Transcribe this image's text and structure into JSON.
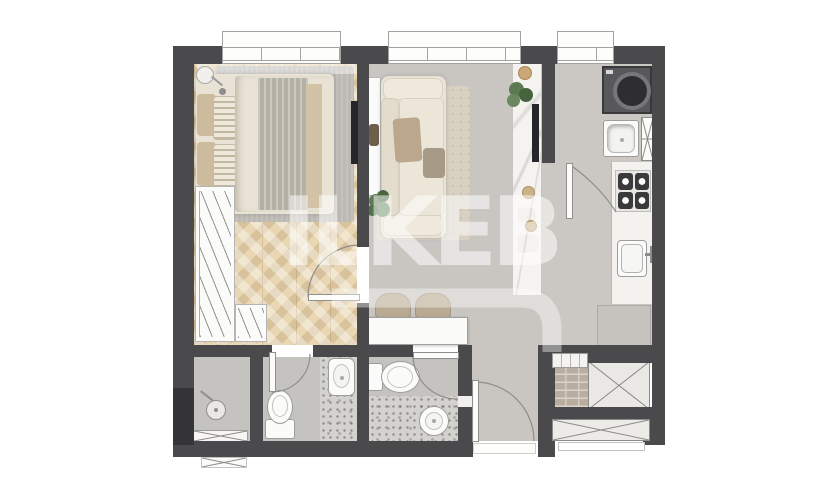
{
  "watermark": {
    "text": "ILKEB"
  },
  "colors": {
    "wall": "#4a4a4c",
    "wall_dark": "#353537",
    "wood": "#e9d6b2",
    "living_floor": "#c9c6c2",
    "kitchen_floor": "#cbc8c3",
    "bath_floor": "#c5c3c0",
    "terrazzo": "#d4d2ce",
    "marble": "#f5f3f0",
    "cream": "#e9e3d5",
    "cream_light": "#efe9dc",
    "tan": "#bba88c",
    "rug_bedroom": "#bcb9b3",
    "rug_living": "#d8d1c2",
    "appliance": "#58585a",
    "tv": "#26262a",
    "plant": "#5b7a52",
    "white": "#fbfbfa",
    "gold": "#c9a876",
    "brick": "#b9ada0"
  },
  "rooms": [
    {
      "name": "bedroom",
      "fixtures": [
        "window",
        "pendant-lamp",
        "double-bed",
        "pillows",
        "rug",
        "wardrobe",
        "tv"
      ]
    },
    {
      "name": "living-room",
      "fixtures": [
        "window",
        "console-table",
        "sofa",
        "rug",
        "floor-plant",
        "marble-tv-wall",
        "tv",
        "dining-table",
        "stools"
      ]
    },
    {
      "name": "kitchen",
      "fixtures": [
        "window",
        "washing-machine",
        "laundry-sink",
        "duct-shaft",
        "counter",
        "cooktop",
        "kitchen-sink",
        "cabinet",
        "brick-shaft",
        "vent"
      ]
    },
    {
      "name": "shower-room",
      "fixtures": [
        "shower-head",
        "drain-strip"
      ]
    },
    {
      "name": "ensuite-bathroom",
      "fixtures": [
        "toilet",
        "washbasin"
      ]
    },
    {
      "name": "guest-bathroom",
      "fixtures": [
        "toilet",
        "round-washbasin"
      ]
    },
    {
      "name": "entry-hall",
      "fixtures": [
        "entrance-door",
        "threshold"
      ]
    }
  ]
}
